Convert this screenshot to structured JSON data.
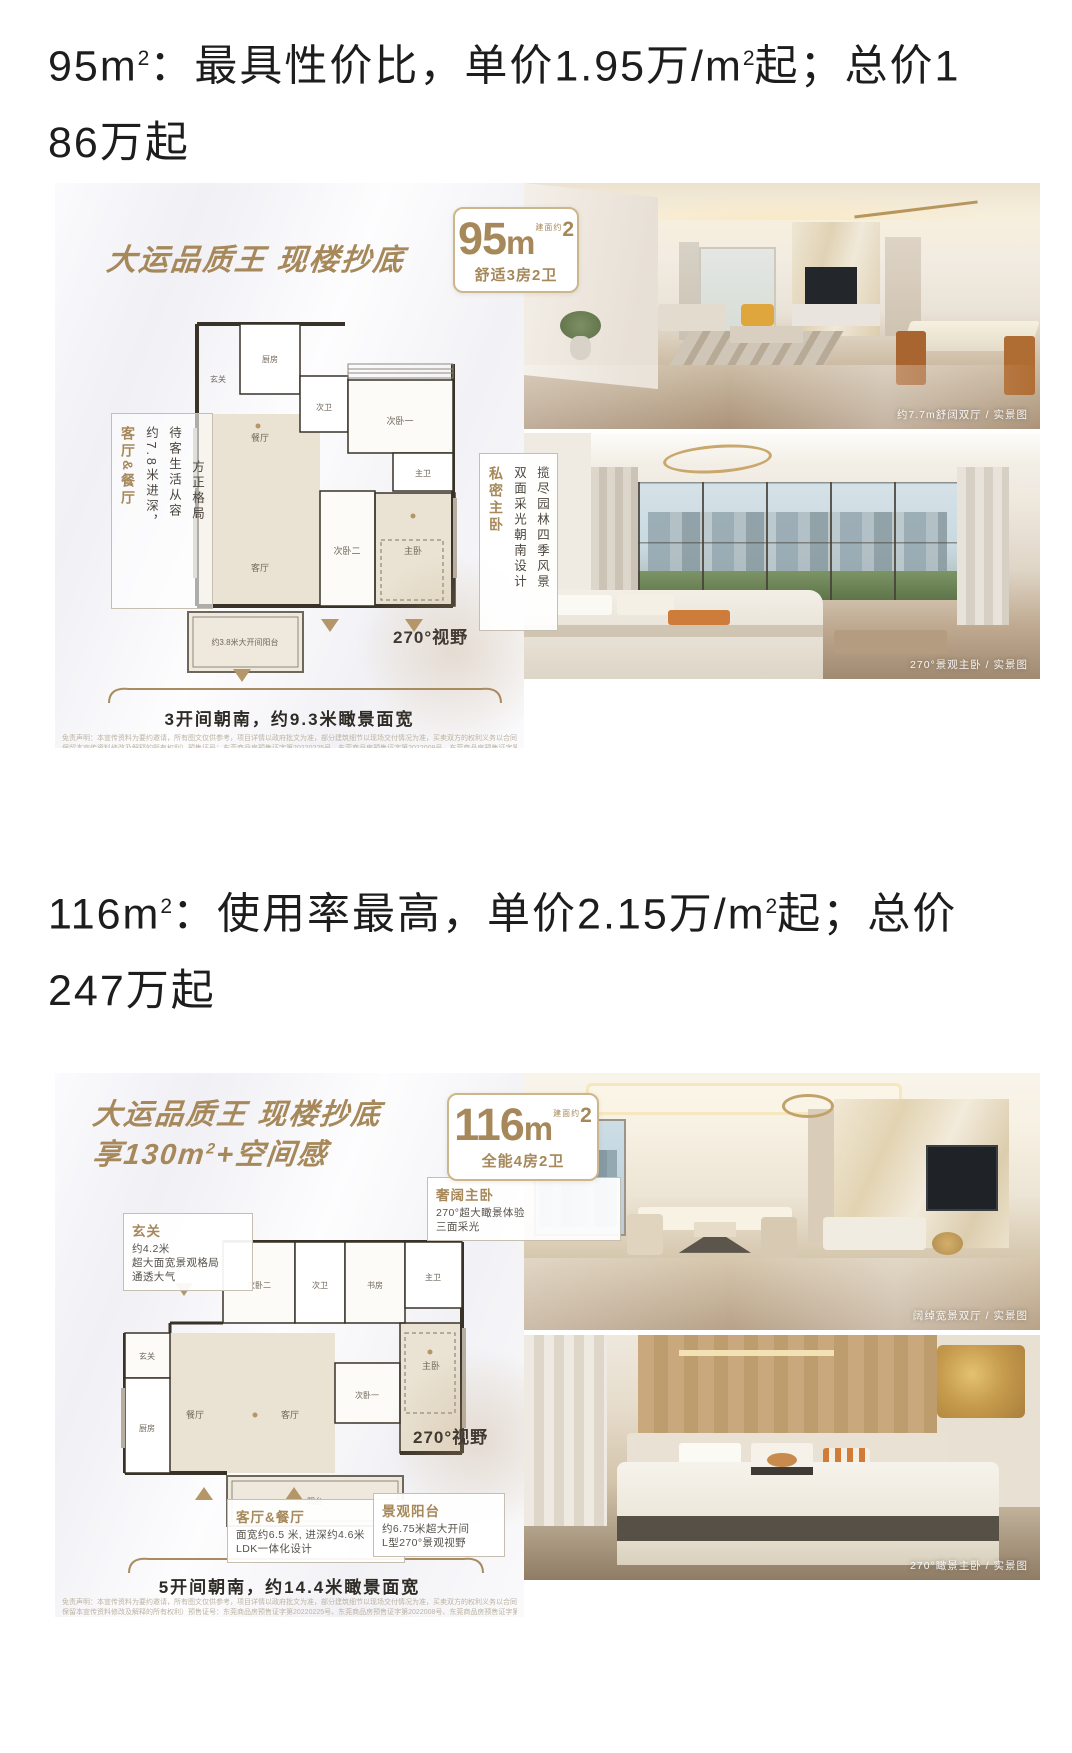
{
  "colors": {
    "gold": "#a6885a",
    "heading": "#1d1d1d",
    "wall": "#383229",
    "beige": "#eae3d4"
  },
  "s1": {
    "heading": {
      "l1a": "95m",
      "l1sup1": "2",
      "l1b": "：最具性价比，单价1.95万/m",
      "l1sup2": "2",
      "l1c": "起；总价1",
      "l2": "86万起"
    },
    "promo": {
      "title": "大运品质王 现楼抄底",
      "badge": {
        "num": "95",
        "unit": "m",
        "approx": "建面约",
        "sup": "2",
        "subtitle": "舒适3房2卫"
      },
      "callout_left": {
        "title": "客厅&餐厅",
        "col1": "约7.8米进深，",
        "col2": "待客生活从容",
        "col3": "方正格局"
      },
      "callout_right": {
        "title": "私密主卧",
        "col1": "双面采光朝南设计",
        "col2": "揽尽园林四季风景"
      },
      "plan": {
        "kitchen": "厨房",
        "foyer": "玄关",
        "bath2": "次卫",
        "bed1": "次卧一",
        "dining": "餐厅",
        "living": "客厅",
        "bed2": "次卧二",
        "master": "主卧",
        "mbath": "主卫",
        "balcony": "约3.8米大开间阳台"
      },
      "view": "270°视野",
      "width_note": "3开间朝南，约9.3米瞰景面宽",
      "disclaimer1": "免责声明：本宣传资料为要约邀请，所有图文仅供参考，项目详情以政府批文为准，部分建筑细节以现场交付情况为准，买卖双方的权利义务以合同约定为准，“朗园山湖”为推广名，项目备案名为：阳光花园（以下",
      "disclaimer2": "保留本宣传资料修改及解释的所有权利）预售证号：东莞商品房预售证字第20220225号、东莞商品房预售证字第2022008号、东莞商品房预售证字第20220480号、东莞商品房预售证字第20220479号、东莞商品房预售证…"
    },
    "photo1": {
      "caption": "约7.7m舒阔双厅 / 实景图"
    },
    "photo2": {
      "caption": "270°景观主卧 / 实景图"
    }
  },
  "s2": {
    "heading": {
      "l1a": "116m",
      "l1sup1": "2",
      "l1b": "：使用率最高，单价2.15万/m",
      "l1sup2": "2",
      "l1c": "起；总价",
      "l2": "247万起"
    },
    "promo": {
      "title": "大运品质王 现楼抄底",
      "title2a": "享130m",
      "title2sup": "2",
      "title2b": "+空间感",
      "badge": {
        "num": "116",
        "unit": "m",
        "approx": "建面约",
        "sup": "2",
        "subtitle": "全能4房2卫"
      },
      "callout_master": {
        "title": "奢阔主卧",
        "line1": "270°超大瞰景体验",
        "line2": "三面采光"
      },
      "callout_foyer": {
        "title": "玄关",
        "line1": "约4.2米",
        "line2": "超大面宽景观格局",
        "line3": "通透大气"
      },
      "callout_living": {
        "title": "客厅&餐厅",
        "line1": "面宽约6.5 米, 进深约4.6米",
        "line2": "LDK一体化设计"
      },
      "callout_balcony": {
        "title": "景观阳台",
        "line1": "约6.75米超大开间",
        "line2": "L型270°景观视野"
      },
      "plan": {
        "bed2": "次卧二",
        "bath2": "次卫",
        "study": "书房",
        "mbath": "主卫",
        "foyer": "玄关",
        "kitchen": "厨房",
        "dining": "餐厅",
        "living": "客厅",
        "bed1": "次卧一",
        "master": "主卧",
        "balcony": "阳台"
      },
      "view": "270°视野",
      "width_note": "5开间朝南，约14.4米瞰景面宽",
      "disclaimer1": "免责声明：本宣传资料为要约邀请，所有图文仅供参考，项目详情以政府批文为准，部分建筑细节以现场交付情况为准，买卖双方的权利义务以合同约定为准，“朗园山湖”为推广名，项目备案名为：阳光花园（以下",
      "disclaimer2": "保留本宣传资料修改及解释的所有权利）预售证号：东莞商品房预售证字第20220225号、东莞商品房预售证字第2022008号、东莞商品房预售证字第20220480号、东莞商品房预售证字第20220479号、东莞商品房预售证…"
    },
    "photo1": {
      "caption": "阔绰宽景双厅 / 实景图"
    },
    "photo2": {
      "caption": "270°瞰景主卧 / 实景图"
    }
  }
}
